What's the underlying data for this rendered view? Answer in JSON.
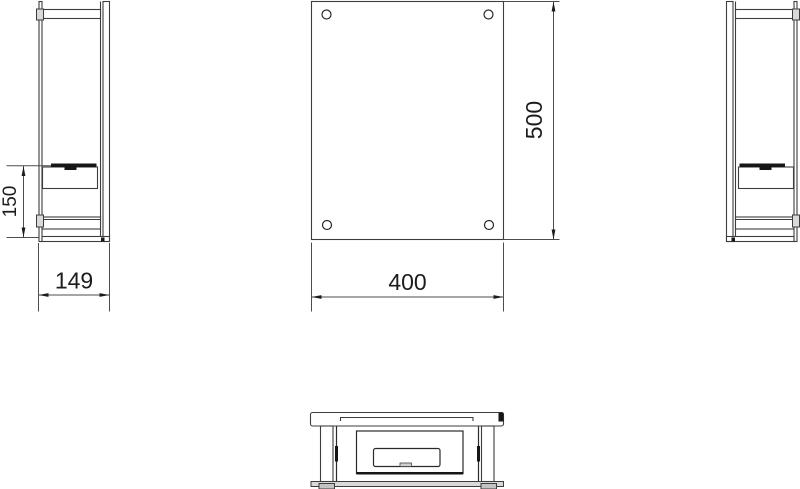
{
  "page": {
    "background": "#ffffff"
  },
  "drawing": {
    "type": "orthographic-technical-drawing",
    "views": [
      {
        "id": "left-side-view"
      },
      {
        "id": "front-view"
      },
      {
        "id": "right-side-view"
      },
      {
        "id": "plan-view"
      }
    ],
    "dimensions": {
      "burner_height": {
        "value": "150"
      },
      "depth": {
        "value": "149"
      },
      "width": {
        "value": "400"
      },
      "height": {
        "value": "500"
      }
    },
    "colors": {
      "line": "#3d3d3d",
      "accent_black": "#161616",
      "fill_gray": "#d9d9d9",
      "dimension_text": "#1c1c1c",
      "background": "#ffffff"
    }
  }
}
